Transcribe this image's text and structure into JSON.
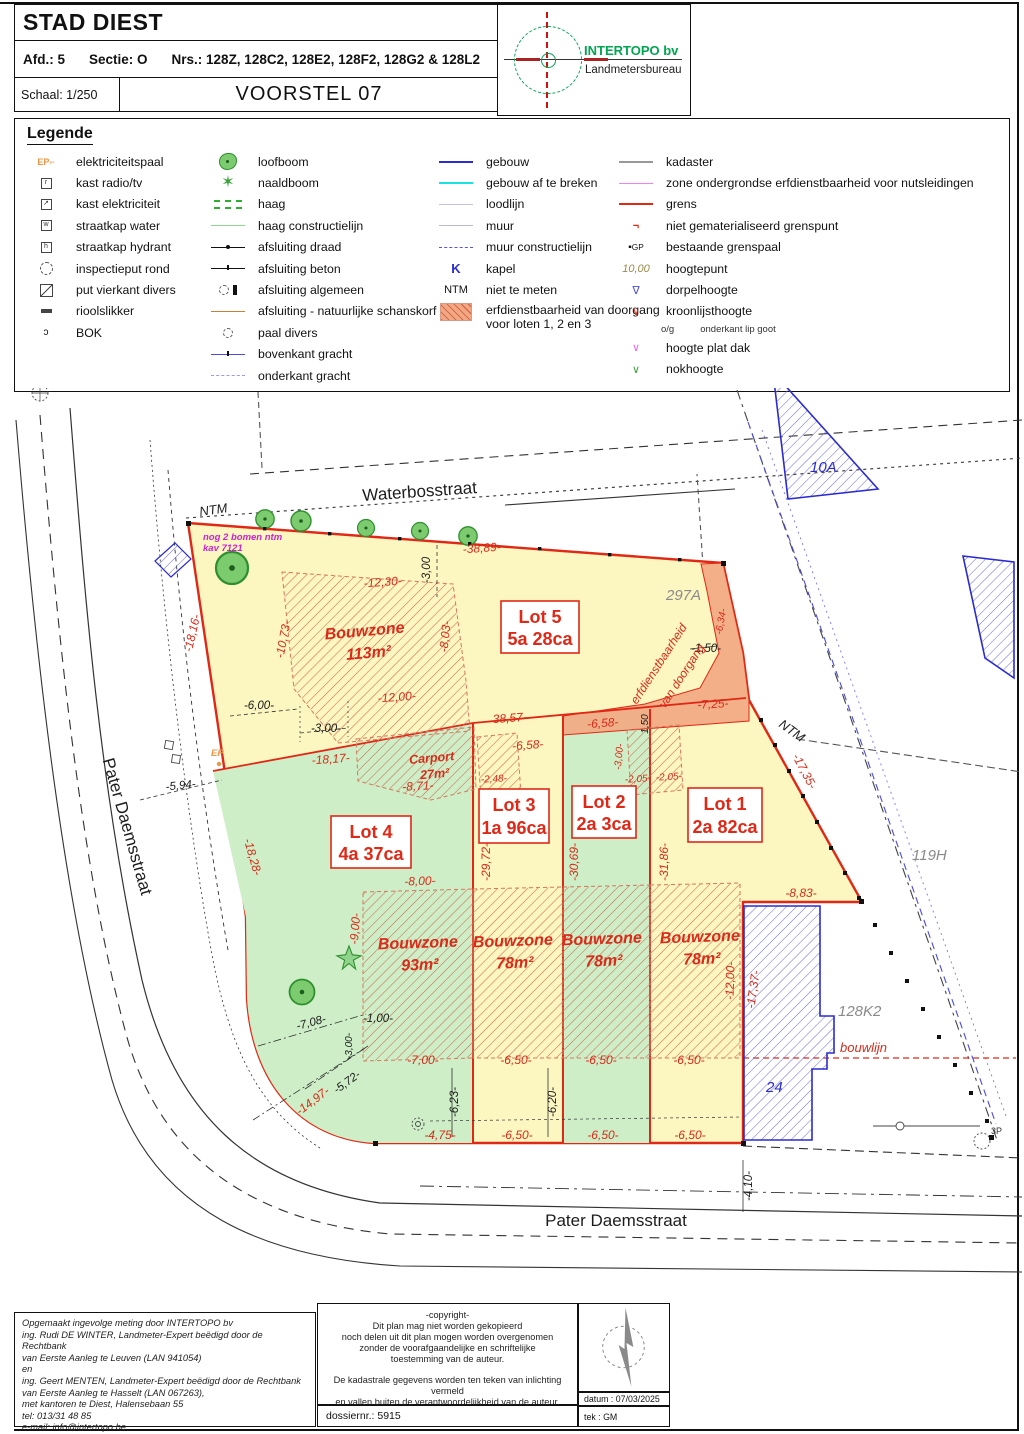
{
  "header": {
    "title": "STAD DIEST",
    "afd": "Afd.: 5",
    "sectie": "Sectie: O",
    "nrs": "Nrs.: 128Z, 128C2, 128E2, 128F2, 128G2 & 128L2",
    "schaal": "Schaal: 1/250",
    "voorstel": "VOORSTEL 07",
    "logo_name": "INTERTOPO bv",
    "logo_sub": "Landmetersbureau"
  },
  "legend": {
    "title": "Legende",
    "col1": [
      {
        "label": "elektriciteitspaal"
      },
      {
        "label": "kast radio/tv"
      },
      {
        "label": "kast elektriciteit"
      },
      {
        "label": "straatkap water"
      },
      {
        "label": "straatkap hydrant"
      },
      {
        "label": "inspectieput rond"
      },
      {
        "label": "put vierkant divers"
      },
      {
        "label": "rioolslikker"
      },
      {
        "label": "BOK"
      }
    ],
    "col2": [
      {
        "label": "loofboom"
      },
      {
        "label": "naaldboom"
      },
      {
        "label": "haag"
      },
      {
        "label": "haag constructielijn"
      },
      {
        "label": "afsluiting draad"
      },
      {
        "label": "afsluiting beton"
      },
      {
        "label": "afsluiting algemeen"
      },
      {
        "label": "afsluiting - natuurlijke schanskorf"
      },
      {
        "label": "paal divers"
      },
      {
        "label": "bovenkant gracht"
      },
      {
        "label": "onderkant gracht"
      }
    ],
    "col3": [
      {
        "label": "gebouw"
      },
      {
        "label": "gebouw af te breken"
      },
      {
        "label": "loodlijn"
      },
      {
        "label": "muur"
      },
      {
        "label": "muur constructielijn"
      },
      {
        "label": "kapel",
        "icon_text": "K"
      },
      {
        "label": "niet te meten",
        "icon_text": "NTM"
      },
      {
        "label": "erfdienstbaarheid van doorgang",
        "label2": "voor loten 1, 2 en 3"
      }
    ],
    "col4": [
      {
        "label": "kadaster"
      },
      {
        "label": "zone ondergrondse erfdienstbaarheid voor nutsleidingen"
      },
      {
        "label": "grens"
      },
      {
        "label": "niet gematerialiseerd grenspunt"
      },
      {
        "label": "bestaande grenspaal",
        "icon_text": "GP"
      },
      {
        "label": "hoogtepunt",
        "icon_text": "10,00"
      },
      {
        "label": "dorpelhoogte"
      },
      {
        "label": "kroonlijsthoogte",
        "sub1": "o/g",
        "sub2": "onderkant lip goot"
      },
      {
        "label": "hoogte plat dak"
      },
      {
        "label": "nokhoogte"
      }
    ]
  },
  "map": {
    "street_top": "Waterbosstraat",
    "street_left": "Pater Daemsstraat",
    "street_bottom": "Pater Daemsstraat",
    "ntm": "NTM",
    "note1": "nog 2 bomen ntm",
    "note2": "kav 7121",
    "ep": "EP",
    "p3p": "3P",
    "parcel_297a": "297A",
    "parcel_119h": "119H",
    "parcel_128k2": "128K2",
    "parcel_10a": "10A",
    "parcel_24": "24",
    "bouwlijn": "bouwlijn",
    "servitude1": "erfdienstbaarheid",
    "servitude2": "van doorgang",
    "lots": [
      {
        "name": "Lot 1",
        "area": "2a 82ca"
      },
      {
        "name": "Lot 2",
        "area": "2a 3ca"
      },
      {
        "name": "Lot 3",
        "area": "1a 96ca"
      },
      {
        "name": "Lot 4",
        "area": "4a 37ca"
      },
      {
        "name": "Lot 5",
        "area": "5a 28ca"
      }
    ],
    "zones": {
      "bouwzone": "Bouwzone",
      "z113": "113m²",
      "z93": "93m²",
      "z78": "78m²",
      "carport": "Carport",
      "c27": "27m²"
    },
    "dims": {
      "d38_89": "-38,89-",
      "d12_30": "-12,30-",
      "d3_00t": "-3,00",
      "d18_16": "-18,16-",
      "d10_73": "-10,73-",
      "d8_03": "-8,03-",
      "d6_00": "-6,00-",
      "d3_00": "-3,00-",
      "d12_00": "-12,00-",
      "d38_57": "38,57-",
      "d18_17": "-18,17-",
      "d8_71": "-8,71-",
      "d2_48": "-2,48-",
      "d6_58": "-6,58-",
      "d2_05": "-2,05-",
      "d7_25": "-7,25-",
      "d1_50": "-1,50-",
      "d1_50b": "1,50",
      "d6_34": "-6,34-",
      "d17_35": "-17,35-",
      "d5_94": "-5,94-",
      "d18_28": "-18,28-",
      "d9_00": "-9,00-",
      "d8_00": "-8,00-",
      "d29_72": "-29,72-",
      "d30_69": "-30,69-",
      "d31_86": "-31,86-",
      "d8_83": "-8,83-",
      "d17_37": "-17,37-",
      "d1_00": "-1,00-",
      "d7_00": "-7,00-",
      "d7_08": "-7,08-",
      "d5_72": "-5,72-",
      "d14_97": "-14,97-",
      "d6_23": "-6,23-",
      "d6_20": "-6,20-",
      "d6_50": "-6,50-",
      "d4_75": "-4,75-",
      "d4_10": "-4,10-"
    }
  },
  "footer": {
    "left": [
      "Opgemaakt ingevolge meting door INTERTOPO bv",
      "ing. Rudi DE WINTER, Landmeter-Expert beëdigd door de Rechtbank",
      "van Eerste Aanleg te Leuven (LAN 941054)",
      "en",
      "ing. Geert MENTEN, Landmeter-Expert beëdigd door de Rechtbank",
      "van Eerste Aanleg te Hasselt (LAN 067263),",
      "met kantoren te Diest, Halensebaan 55",
      "tel: 013/31 48 85",
      "e-mail: info@intertopo.be"
    ],
    "copyright": [
      "-copyright-",
      "Dit plan mag niet worden gekopieerd",
      "noch delen uit dit plan mogen worden overgenomen",
      "zonder de voorafgaandelijke en schriftelijke",
      "toestemming van de auteur.",
      "",
      "De kadastrale gegevens worden ten teken van inlichting vermeld",
      "en vallen buiten de verantwoordelijkheid van de auteur."
    ],
    "dossier": "dossiernr.: 5915",
    "datum": "datum : 07/03/2025",
    "tek": "tek : GM"
  },
  "colors": {
    "grens_red": "#e02817",
    "parcel_yellow": "#fcf6c0",
    "parcel_green": "#cdeec6",
    "servitude_salmon": "#f2a983",
    "building_blue": "#2b2bd0",
    "logo_green": "#00a651",
    "note_magenta": "#cc22cc"
  }
}
